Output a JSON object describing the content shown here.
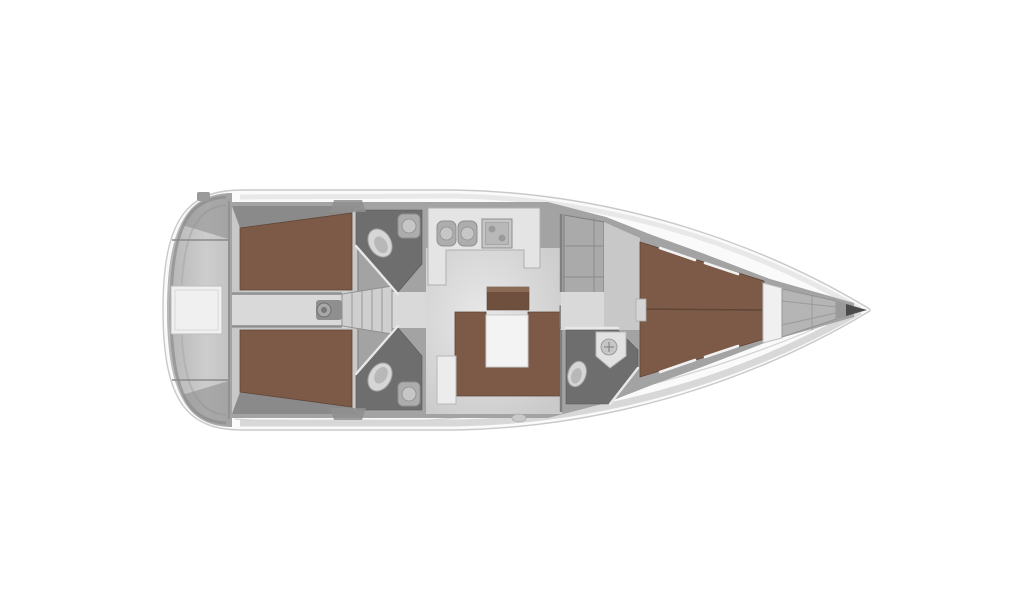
{
  "canvas": {
    "width": 1024,
    "height": 600,
    "background": "#ffffff"
  },
  "diagram": {
    "type": "yacht-interior-floorplan",
    "view": "top-down",
    "orientation": "bow-right",
    "regions": [
      "stern-swim-platform",
      "transom-door",
      "aft-cabin-port",
      "aft-cabin-starboard",
      "companionway-corridor",
      "companionway-stairs",
      "engine-pedestal",
      "aft-head-port",
      "aft-head-starboard",
      "galley",
      "saloon",
      "saloon-table",
      "u-settee",
      "sideboard",
      "wardrobe",
      "mast-post",
      "forward-head",
      "forward-cabin",
      "v-berth",
      "bow-bulkhead-panel",
      "anchor-locker",
      "bow-tip"
    ],
    "fixtures": [
      "toilet",
      "washbasin",
      "double-sink",
      "stove",
      "shower-floor"
    ]
  },
  "colors": {
    "background": "#ffffff",
    "hull": "#fafafa",
    "hullStroke": "#c9c9c9",
    "deckTopShade": "#e8e8e8",
    "deckBottomShade": "#d8d8d8",
    "transom": "#c2c2c2",
    "transomDark": "#8f8f8f",
    "wall": "#a3a3a3",
    "wallLine": "#8a8a8a",
    "cabinFloor": "#c8c8c8",
    "corridorFloor": "#d9d9d9",
    "salonFloorLight": "#e8e8e8",
    "salonFloorDark": "#c9c9c9",
    "berth": "#7c5a47",
    "berthEdge": "#5f4536",
    "sideboard": "#6f4f3e",
    "sideboardTop": "#8a6a55",
    "headFloor": "#6e6e6e",
    "fixtureLight": "#e2e2e2",
    "toilet": "#d6d6d6",
    "toiletInner": "#b8b8b8",
    "counter": "#e4e4e4",
    "appliance": "#adadad",
    "applianceDark": "#8f8f8f",
    "table": "#f3f3f3",
    "cabinet": "#ececec",
    "panel": "#f0f0f0",
    "bowDark": "#4a4a4a",
    "stairs": "#cfcfcf",
    "pedestal": "#8f8f8f"
  }
}
